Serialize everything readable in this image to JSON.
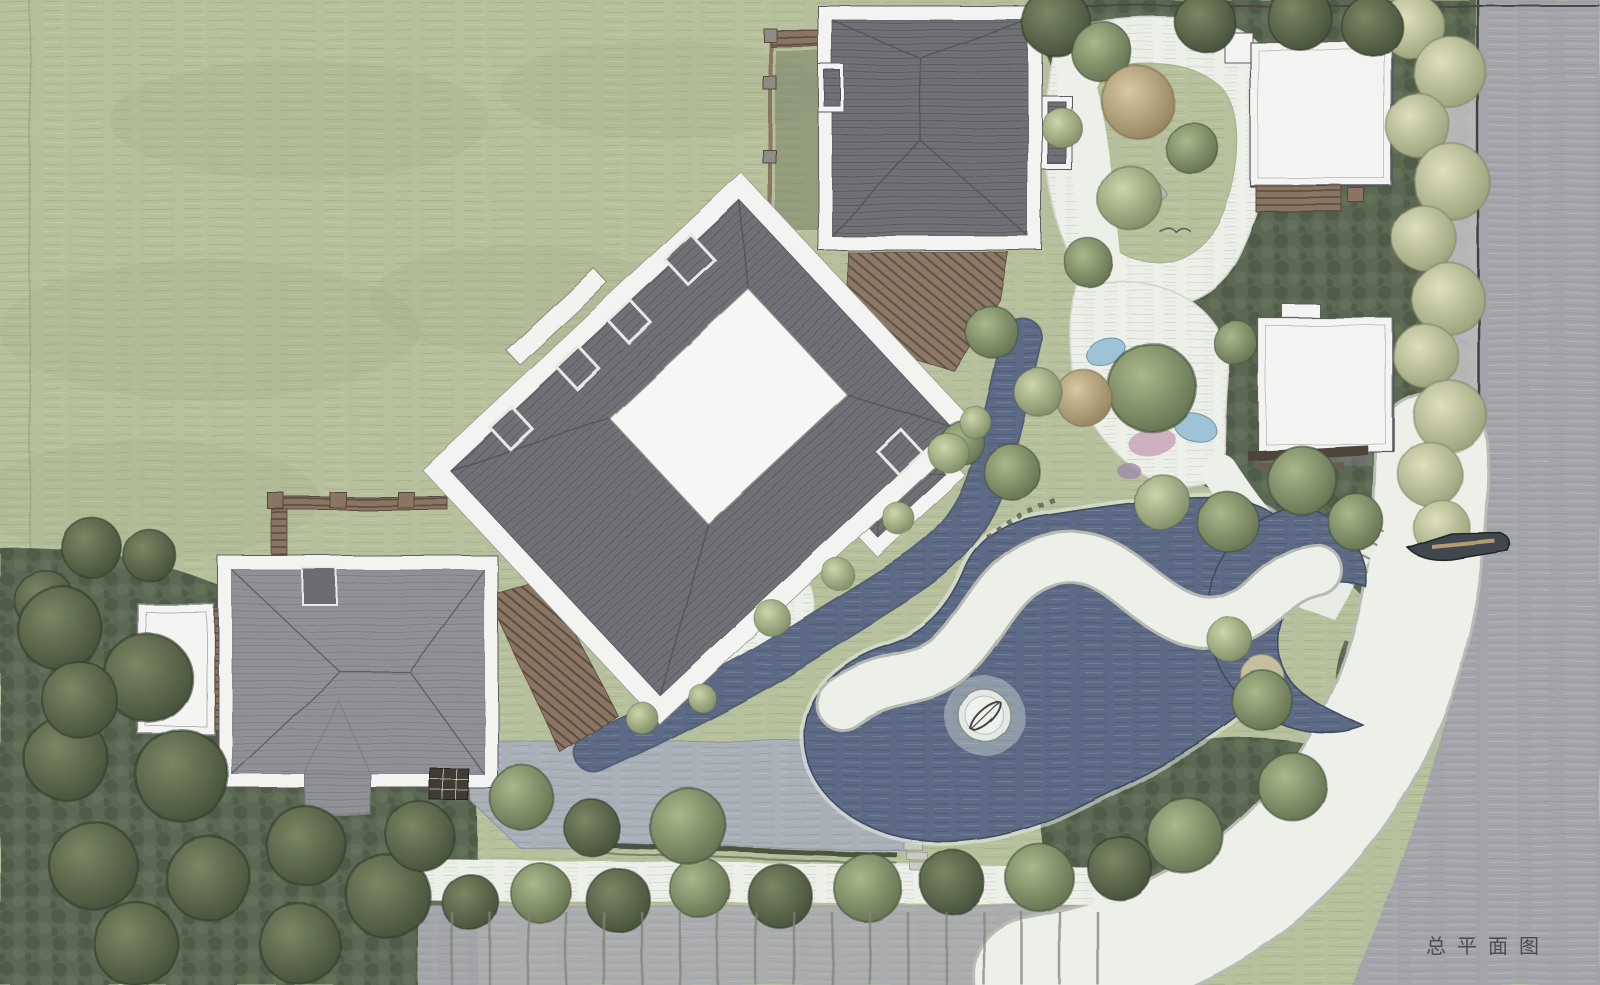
{
  "caption": {
    "text": "总平面图"
  },
  "palette": {
    "grass": "#b6c09c",
    "grassLine": "#9cab7e",
    "grassLight": "#cbd4ab",
    "grassShade": "#90a074",
    "foliage": "#5c6852",
    "foliageDark": "#4c5844",
    "foliageLight": "#66735a",
    "road": "#a4a5ab",
    "roadLine": "#90919a",
    "roadLight": "#b9bac0",
    "sidewalk": "#c6c7ca",
    "water": "#5d6b85",
    "waterDark": "#48556e",
    "waterLight": "#8794aa",
    "roofDark": "#717277",
    "roofLine": "#55565b",
    "roofMid": "#919297",
    "roofMidLine": "#7b7c81",
    "eave": "#f3f4f1",
    "outline": "#5c5d5f",
    "gravel": "#edefe9",
    "gravelLine": "#d2d5cd",
    "paving": "#aab0b8",
    "pavingLine": "#969ca6",
    "wood": "#8a7563",
    "woodDark": "#55483d",
    "pool": "#9ec3d6",
    "flower": "#c7a6b6",
    "purple": "#9f8aa8",
    "khaki": "#c6bf9e",
    "treeYellowA": "#dfe0bc",
    "treeYellowB": "#8f9972",
    "treeLightA": "#cdd6ab",
    "treeLightB": "#74825c",
    "treeMidA": "#aab98a",
    "treeMidB": "#5a684a",
    "treeDarkA": "#7b8663",
    "treeDarkB": "#3f4a36",
    "treeTanA": "#d8c9a2",
    "treeTanB": "#8a7a56",
    "ink": "#3c3c41",
    "boat": "#f0f0ea",
    "steel": "#41464d"
  },
  "scene": {
    "type": "architectural-master-plan",
    "elements": [
      "main-villa",
      "north-villa",
      "west-villa",
      "east-wing",
      "garden-pavilion-north",
      "garden-pavilion-east",
      "pond",
      "pond-island-boat",
      "pool-channel",
      "spiral-steps",
      "promenade",
      "perimeter-road",
      "garden-paths",
      "tree-groves",
      "pergolas",
      "car"
    ]
  }
}
